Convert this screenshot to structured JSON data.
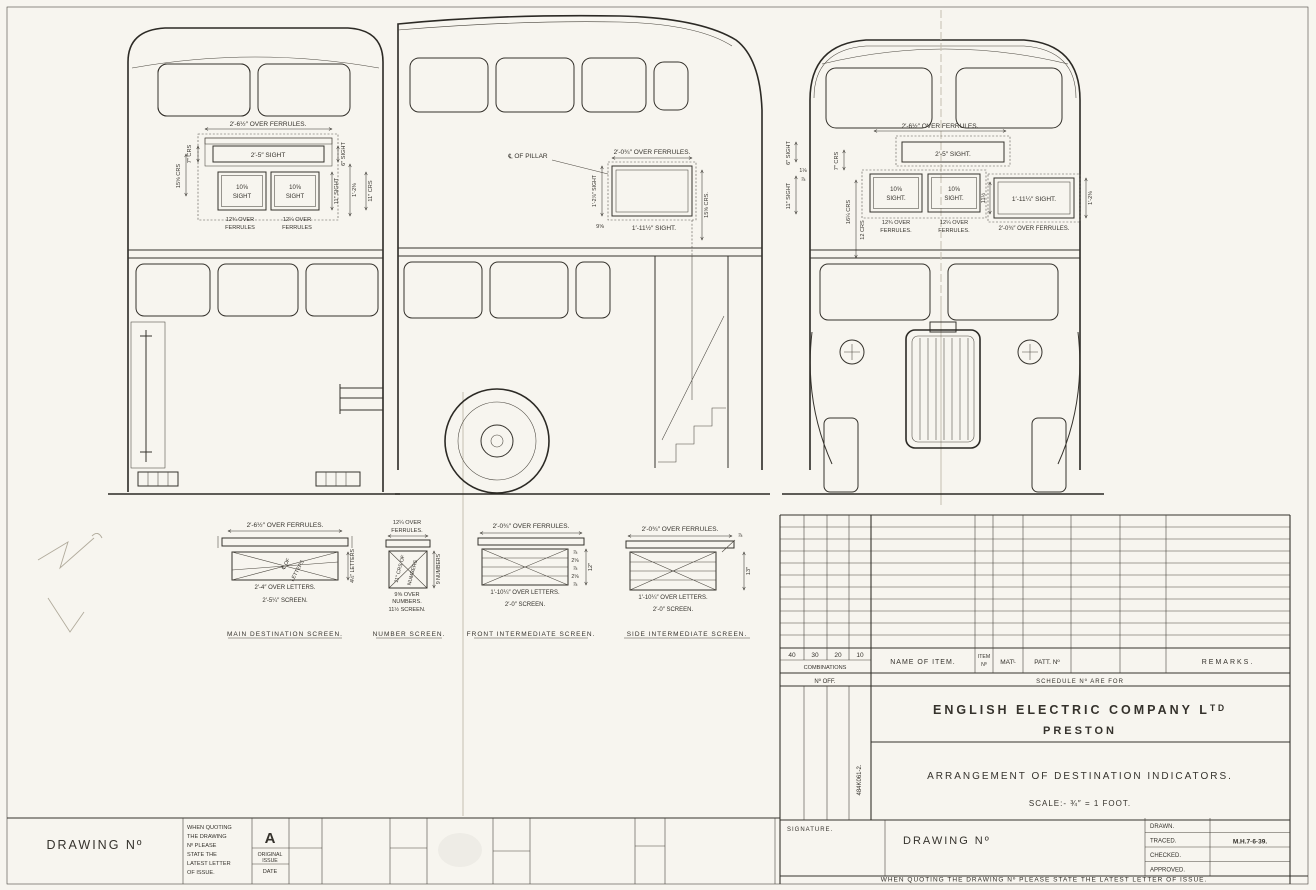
{
  "titleblock": {
    "company": "ENGLISH ELECTRIC COMPANY Lᵀᴰ",
    "city": "PRESTON",
    "drawing_title": "ARRANGEMENT OF DESTINATION INDICATORS.",
    "scale": "SCALE:- ¾″ = 1 FOOT.",
    "code_vertical": "484K061-2."
  },
  "schedule": {
    "cols": [
      "40",
      "30",
      "20",
      "10"
    ],
    "combinations": "COMBINATIONS",
    "no_off": "Nº OFF.",
    "name_of_item": "NAME OF ITEM.",
    "item_1": "ITEM",
    "item_2": "Nº",
    "matl": "MATᴸ",
    "patt_no": "PATT. Nº",
    "remarks": "REMARKS.",
    "schedule_for": "SCHEDULE Nº ARE FOR"
  },
  "issue": {
    "drawing_no": "DRAWING Nº",
    "note": [
      "WHEN QUOTING",
      "THE DRAWING",
      "Nº PLEASE",
      "STATE THE",
      "LATEST LETTER",
      "OF ISSUE."
    ],
    "letter": "A",
    "orig_1": "ORIGINAL",
    "orig_2": "ISSUE",
    "date": "DATE"
  },
  "bottom": {
    "signature": "SIGNATURE.",
    "drawing_no": "DRAWING Nº",
    "drawn": "DRAWN.",
    "traced": "TRACED.",
    "traced_value": "M.H.7·6·39.",
    "checked": "CHECKED.",
    "approved": "APPROVED.",
    "footer": "WHEN QUOTING THE DRAWING Nº PLEASE STATE THE LATEST LETTER OF ISSUE."
  },
  "views": {
    "rear": {
      "over_ferrules": "2′-6½″ OVER FERRULES.",
      "sight": "2′-5″ SIGHT",
      "crs7": "7″ CRS",
      "crs15": "15⅝ CRS",
      "box1a": "10⅝",
      "box1b": "SIGHT",
      "box2a": "10⅝",
      "box2b": "SIGHT",
      "ofl1": "12¾ OVER",
      "ofl2": "FERRULES",
      "ofr1": "12¼ OVER",
      "ofr2": "FERRULES",
      "s6": "6″ SIGHT",
      "s11": "11″ SIGHT",
      "v12": "1′-2⅜",
      "crs11": "11″ CRS"
    },
    "side": {
      "pillar": "℄ OF PILLAR",
      "over_ferrules": "2′-0¾″ OVER FERRULES.",
      "vleft": "1′-2⅞″ SIGHT",
      "v9": "9⅝",
      "bottom_sight": "1′-11½″ SIGHT.",
      "crs15": "15⅝ CRS."
    },
    "front": {
      "over_ferrules": "2′-6½″ OVER FERRULES.",
      "sight": "2′-5″ SIGHT.",
      "s6": "6″ SIGHT",
      "s11": "11″ SIGHT",
      "crs7": "7″ CRS",
      "crs16": "16¼ CRS",
      "crs12": "12 CRS",
      "f1": "1⅛",
      "f2": "⅞",
      "box1a": "10⅝",
      "box1b": "SIGHT.",
      "box2a": "10⅝",
      "box2b": "SIGHT.",
      "side_sight": "1′-11¼″ SIGHT.",
      "v11": "11½",
      "ofl1": "12¾ OVER",
      "ofl2": "FERRULES.",
      "ofr1": "12¼ OVER",
      "ofr2": "FERRULES.",
      "of_bottom": "2′-0¾″ OVER FERRULES.",
      "vright": "1′-2⅜"
    }
  },
  "screens": {
    "main": {
      "label": "MAIN DESTINATION SCREEN.",
      "over_ferrules": "2′-6½″ OVER FERRULES.",
      "diag1": "℄ OF",
      "diag2": "LETTERS",
      "right_v": "4½″ LETTERS",
      "over_letters": "2′-4″ OVER LETTERS.",
      "screen": "2′-5¼″ SCREEN."
    },
    "number": {
      "label": "NUMBER SCREEN.",
      "of1": "12¼ OVER",
      "of2": "FERRULES.",
      "diag1": "11″ CRS OF",
      "diag2": "NUMBERS",
      "right_v": "9 NUMBERS",
      "on1": "9⅝ OVER",
      "on2": "NUMBERS.",
      "screen": "11½ SCREEN."
    },
    "front_int": {
      "label": "FRONT INTERMEDIATE SCREEN.",
      "over_ferrules": "2′-0¾″ OVER FERRULES.",
      "stack": [
        "⅞",
        "2⅝",
        "⅞",
        "2⅝",
        "⅞"
      ],
      "depth": "12″",
      "over_letters": "1′-10¼″ OVER LETTERS.",
      "screen": "2′-0″ SCREEN."
    },
    "side_int": {
      "label": "SIDE INTERMEDIATE SCREEN.",
      "over_ferrules": "2′-0¾″ OVER FERRULES.",
      "ferrule": "⅞",
      "depth": "13″",
      "over_letters": "1′-10¼″ OVER LETTERS.",
      "screen": "2′-0″ SCREEN."
    }
  }
}
